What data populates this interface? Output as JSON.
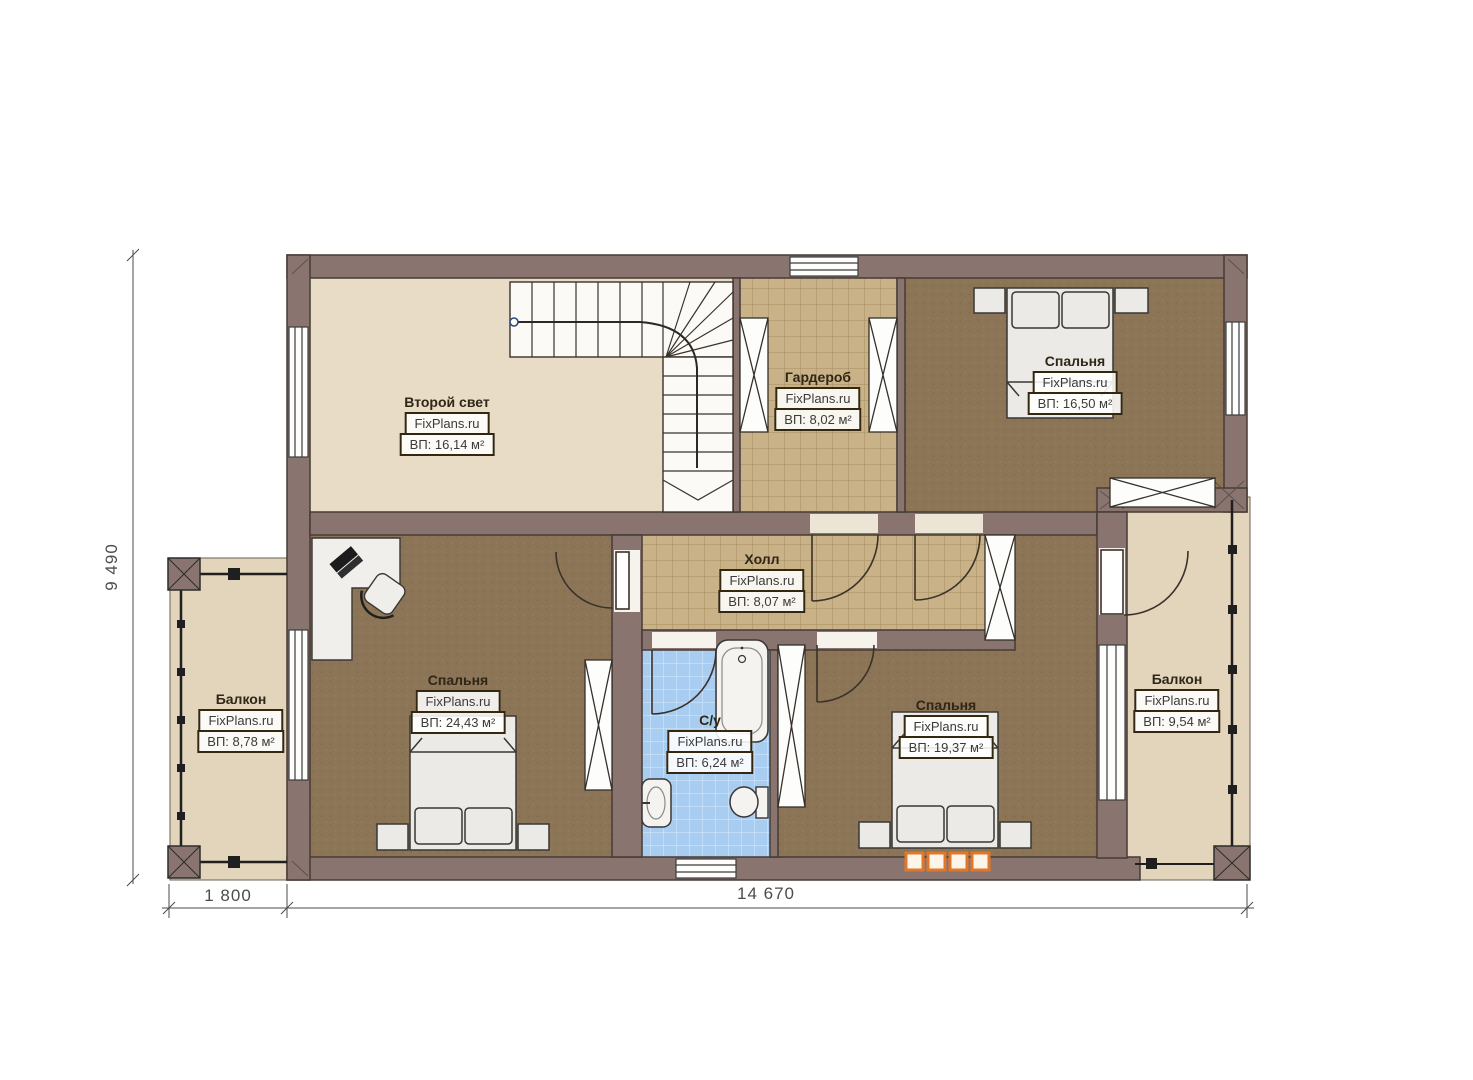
{
  "brand": "FixPlans.ru",
  "rooms": {
    "second_light": {
      "name": "Второй свет",
      "area": "ВП: 16,14 м²"
    },
    "wardrobe": {
      "name": "Гардероб",
      "area": "ВП: 8,02 м²"
    },
    "bedroom_top": {
      "name": "Спальня",
      "area": "ВП: 16,50 м²"
    },
    "hall": {
      "name": "Холл",
      "area": "ВП: 8,07 м²"
    },
    "bedroom_left": {
      "name": "Спальня",
      "area": "ВП: 24,43 м²"
    },
    "bathroom": {
      "name": "С/у",
      "area": "ВП: 6,24 м²"
    },
    "bedroom_right": {
      "name": "Спальня",
      "area": "ВП: 19,37 м²"
    },
    "balcony_left": {
      "name": "Балкон",
      "area": "ВП: 8,78 м²"
    },
    "balcony_right": {
      "name": "Балкон",
      "area": "ВП: 9,54 м²"
    }
  },
  "dimensions": {
    "height_total": "9 490",
    "width_balcony": "1 800",
    "width_main": "14 670"
  },
  "colors": {
    "wall": "#8A7470",
    "floor_bedroom": "#8C7456",
    "floor_tile": "#C9B287",
    "floor_bath": "#A8CDF0",
    "floor_light": "#E8DCC7",
    "floor_balcony": "#E3D5BC",
    "radiator_orange": "#E0782A"
  }
}
